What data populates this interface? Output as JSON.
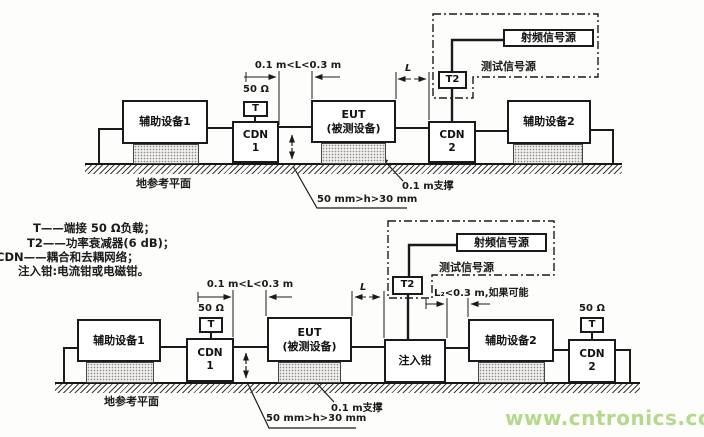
{
  "diagram": {
    "labels": {
      "aux1": "辅助设备1",
      "aux2": "辅助设备2",
      "cdn1": "CDN\n1",
      "cdn2": "CDN\n2",
      "eut": "EUT\n(被测设备)",
      "t": "T",
      "t2": "T2",
      "load_50ohm": "50 Ω",
      "rf_source": "射频信号源",
      "test_source": "测试信号源",
      "injection_clamp": "注入钳",
      "ground_plane": "地参考平面",
      "support": "0.1 m支撑",
      "dim_L_range": "0.1 m<L<0.3 m",
      "dim_L": "L",
      "dim_L2": "L₂<0.3 m,如果可能",
      "dim_h": "50 mm>h>30 mm"
    },
    "legend": [
      "T——端接 50 Ω负载；",
      "T2——功率衰减器(6 dB)；",
      "CDN——耦合和去耦网络；",
      "注入钳:电流钳或电磁钳。"
    ],
    "watermark": "www.cntronics.com",
    "colors": {
      "line": "#1a1a1a",
      "watermark": "#b5d98b",
      "background": "#fdfdfc"
    }
  }
}
